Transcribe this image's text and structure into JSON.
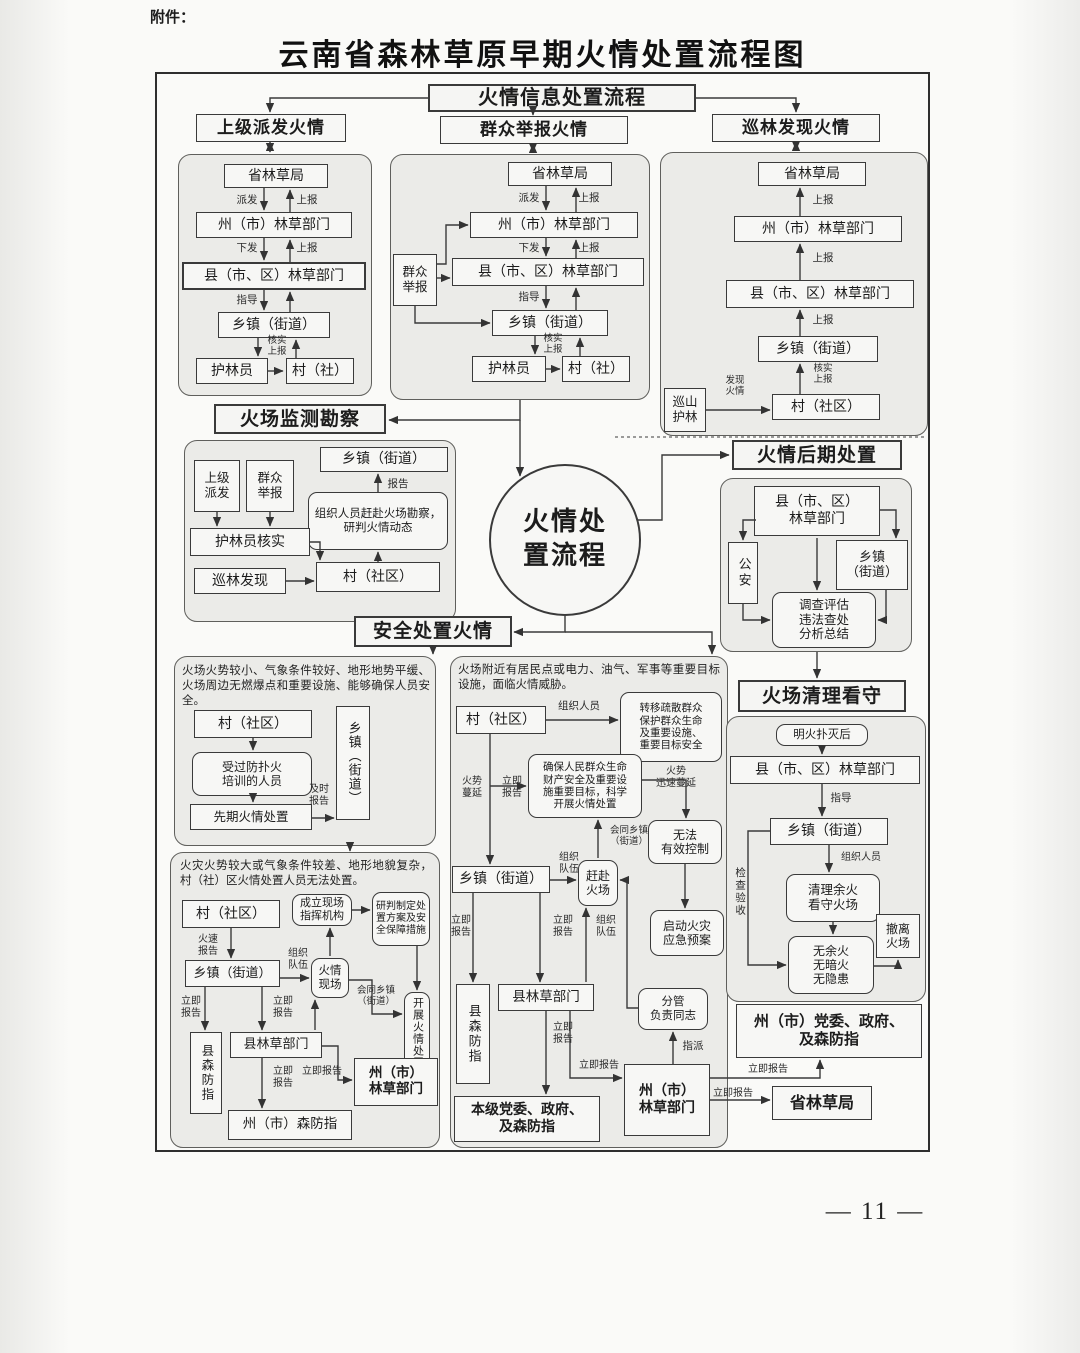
{
  "page": {
    "attachment": "附件：",
    "title": "云南省森林草原早期火情处置流程图",
    "page_number": "— 11 —"
  },
  "info": {
    "header": "火情信息处置流程"
  },
  "dispatch": {
    "title": "上级派发火情",
    "province": "省林草局",
    "prefecture": "州（市）林草部门",
    "county": "县（市、区）林草部门",
    "township": "乡镇（街道）",
    "ranger": "护林员",
    "village": "村（社）",
    "lbl_dispatch": "派发",
    "lbl_report": "上报",
    "lbl_issue": "下发",
    "lbl_guide": "指导",
    "lbl_verify_report": "核实\n上报"
  },
  "public": {
    "title": "群众举报火情",
    "reporter": "群众\n举报",
    "province": "省林草局",
    "prefecture": "州（市）林草部门",
    "county": "县（市、区）林草部门",
    "township": "乡镇（街道）",
    "ranger": "护林员",
    "village": "村（社）",
    "lbl_dispatch": "派发",
    "lbl_report": "上报",
    "lbl_issue": "下发",
    "lbl_guide": "指导",
    "lbl_verify_report": "核实\n上报"
  },
  "patrol": {
    "title": "巡林发现火情",
    "province": "省林草局",
    "prefecture": "州（市）林草部门",
    "county": "县（市、区）林草部门",
    "township": "乡镇（街道）",
    "village": "村（社区）",
    "patroller": "巡山\n护林",
    "lbl_found": "发现\n火情",
    "lbl_report": "上报",
    "lbl_verify_report": "核实\n上报"
  },
  "monitor": {
    "title": "火场监测勘察",
    "township": "乡镇（街道）",
    "superior": "上级\n派发",
    "masses": "群众\n举报",
    "verify": "护林员核实",
    "found": "巡林发现",
    "village": "村（社区）",
    "task": "组织人员赶赴火场勘察，研判火情动态",
    "lbl_report": "报告"
  },
  "circle": {
    "text": "火情处置流程"
  },
  "post": {
    "title": "火情后期处置",
    "county": "县（市、区）\n林草部门",
    "police": "公安",
    "township": "乡镇\n（街道）",
    "actions": "调查评估\n违法查处\n分析总结"
  },
  "safe": {
    "title": "安全处置火情"
  },
  "small_fire": {
    "condition": "火场火势较小、气象条件较好、地形地势平缓、火场周边无燃爆点和重要设施、能够确保人员安全。",
    "village": "村（社区）",
    "township": "乡镇（街道）",
    "trained": "受过防扑火\n培训的人员",
    "early": "先期火情处置",
    "lbl_timely": "及时\n报告"
  },
  "threat_fire": {
    "condition": "火场附近有居民点或电力、油气、军事等重要目标设施，面临火情威胁。",
    "village": "村（社区）",
    "lbl_organize": "组织人员",
    "evacuate": "转移疏散群众\n保护群众生命\n及重要设施、\n重要目标安全",
    "ensure": "确保人民群众生命\n财产安全及重要设\n施重要目标，科学\n开展火情处置",
    "lbl_spread": "火势\n蔓延",
    "lbl_report_s": "立即\n报告",
    "lbl_spread_fast": "火势\n迅速蔓延",
    "uncontrolled": "无法\n有效控制",
    "emergency": "启动火灾\n应急预案",
    "township": "乡镇（街道）",
    "lbl_team": "组织\n队伍",
    "rush": "赶赴\n火场",
    "lbl_joint": "会同乡镇\n（街道）",
    "county_cmd": "县森防指",
    "county": "县林草部门",
    "local_gov": "本级党委、政府、\n及森防指",
    "lbl_report": "立即报告",
    "prefecture": "州（市）\n林草部门",
    "incharge": "分管\n负责同志",
    "lbl_assign": "指派"
  },
  "large_fire": {
    "condition": "火灾火势较大或气象条件较差、地形地貌复杂，村（社）区火情处置人员无法处置。",
    "village": "村（社区）",
    "lbl_urgent": "火速\n报告",
    "command": "成立现场\n指挥机构",
    "plan": "研判制定处\n置方案及安\n全保障措施",
    "township": "乡镇（街道）",
    "lbl_team": "组织\n队伍",
    "scene": "火情\n现场",
    "lbl_joint": "会同乡镇\n（街道）",
    "carry": "开展火情处置",
    "county_cmd": "县森防指",
    "county": "县林草部门",
    "lbl_report_s": "立即\n报告",
    "lbl_report": "立即报告",
    "pref_cmd": "州（市）森防指",
    "prefecture": "州（市）\n林草部门"
  },
  "cleanup": {
    "title": "火场清理看守",
    "after": "明火扑灭后",
    "county": "县（市、区）林草部门",
    "lbl_guide": "指导",
    "township": "乡镇（街道）",
    "lbl_organize": "组织人员",
    "clear": "清理余火\n看守火场",
    "three_no": "无余火\n无暗火\n无隐患",
    "leave": "撤离\n火场",
    "lbl_inspect": "检查验收"
  },
  "gov": {
    "party": "州（市）党委、政府、\n及森防指",
    "province": "省林草局",
    "lbl_report1": "立即报告",
    "lbl_report2": "立即报告"
  }
}
